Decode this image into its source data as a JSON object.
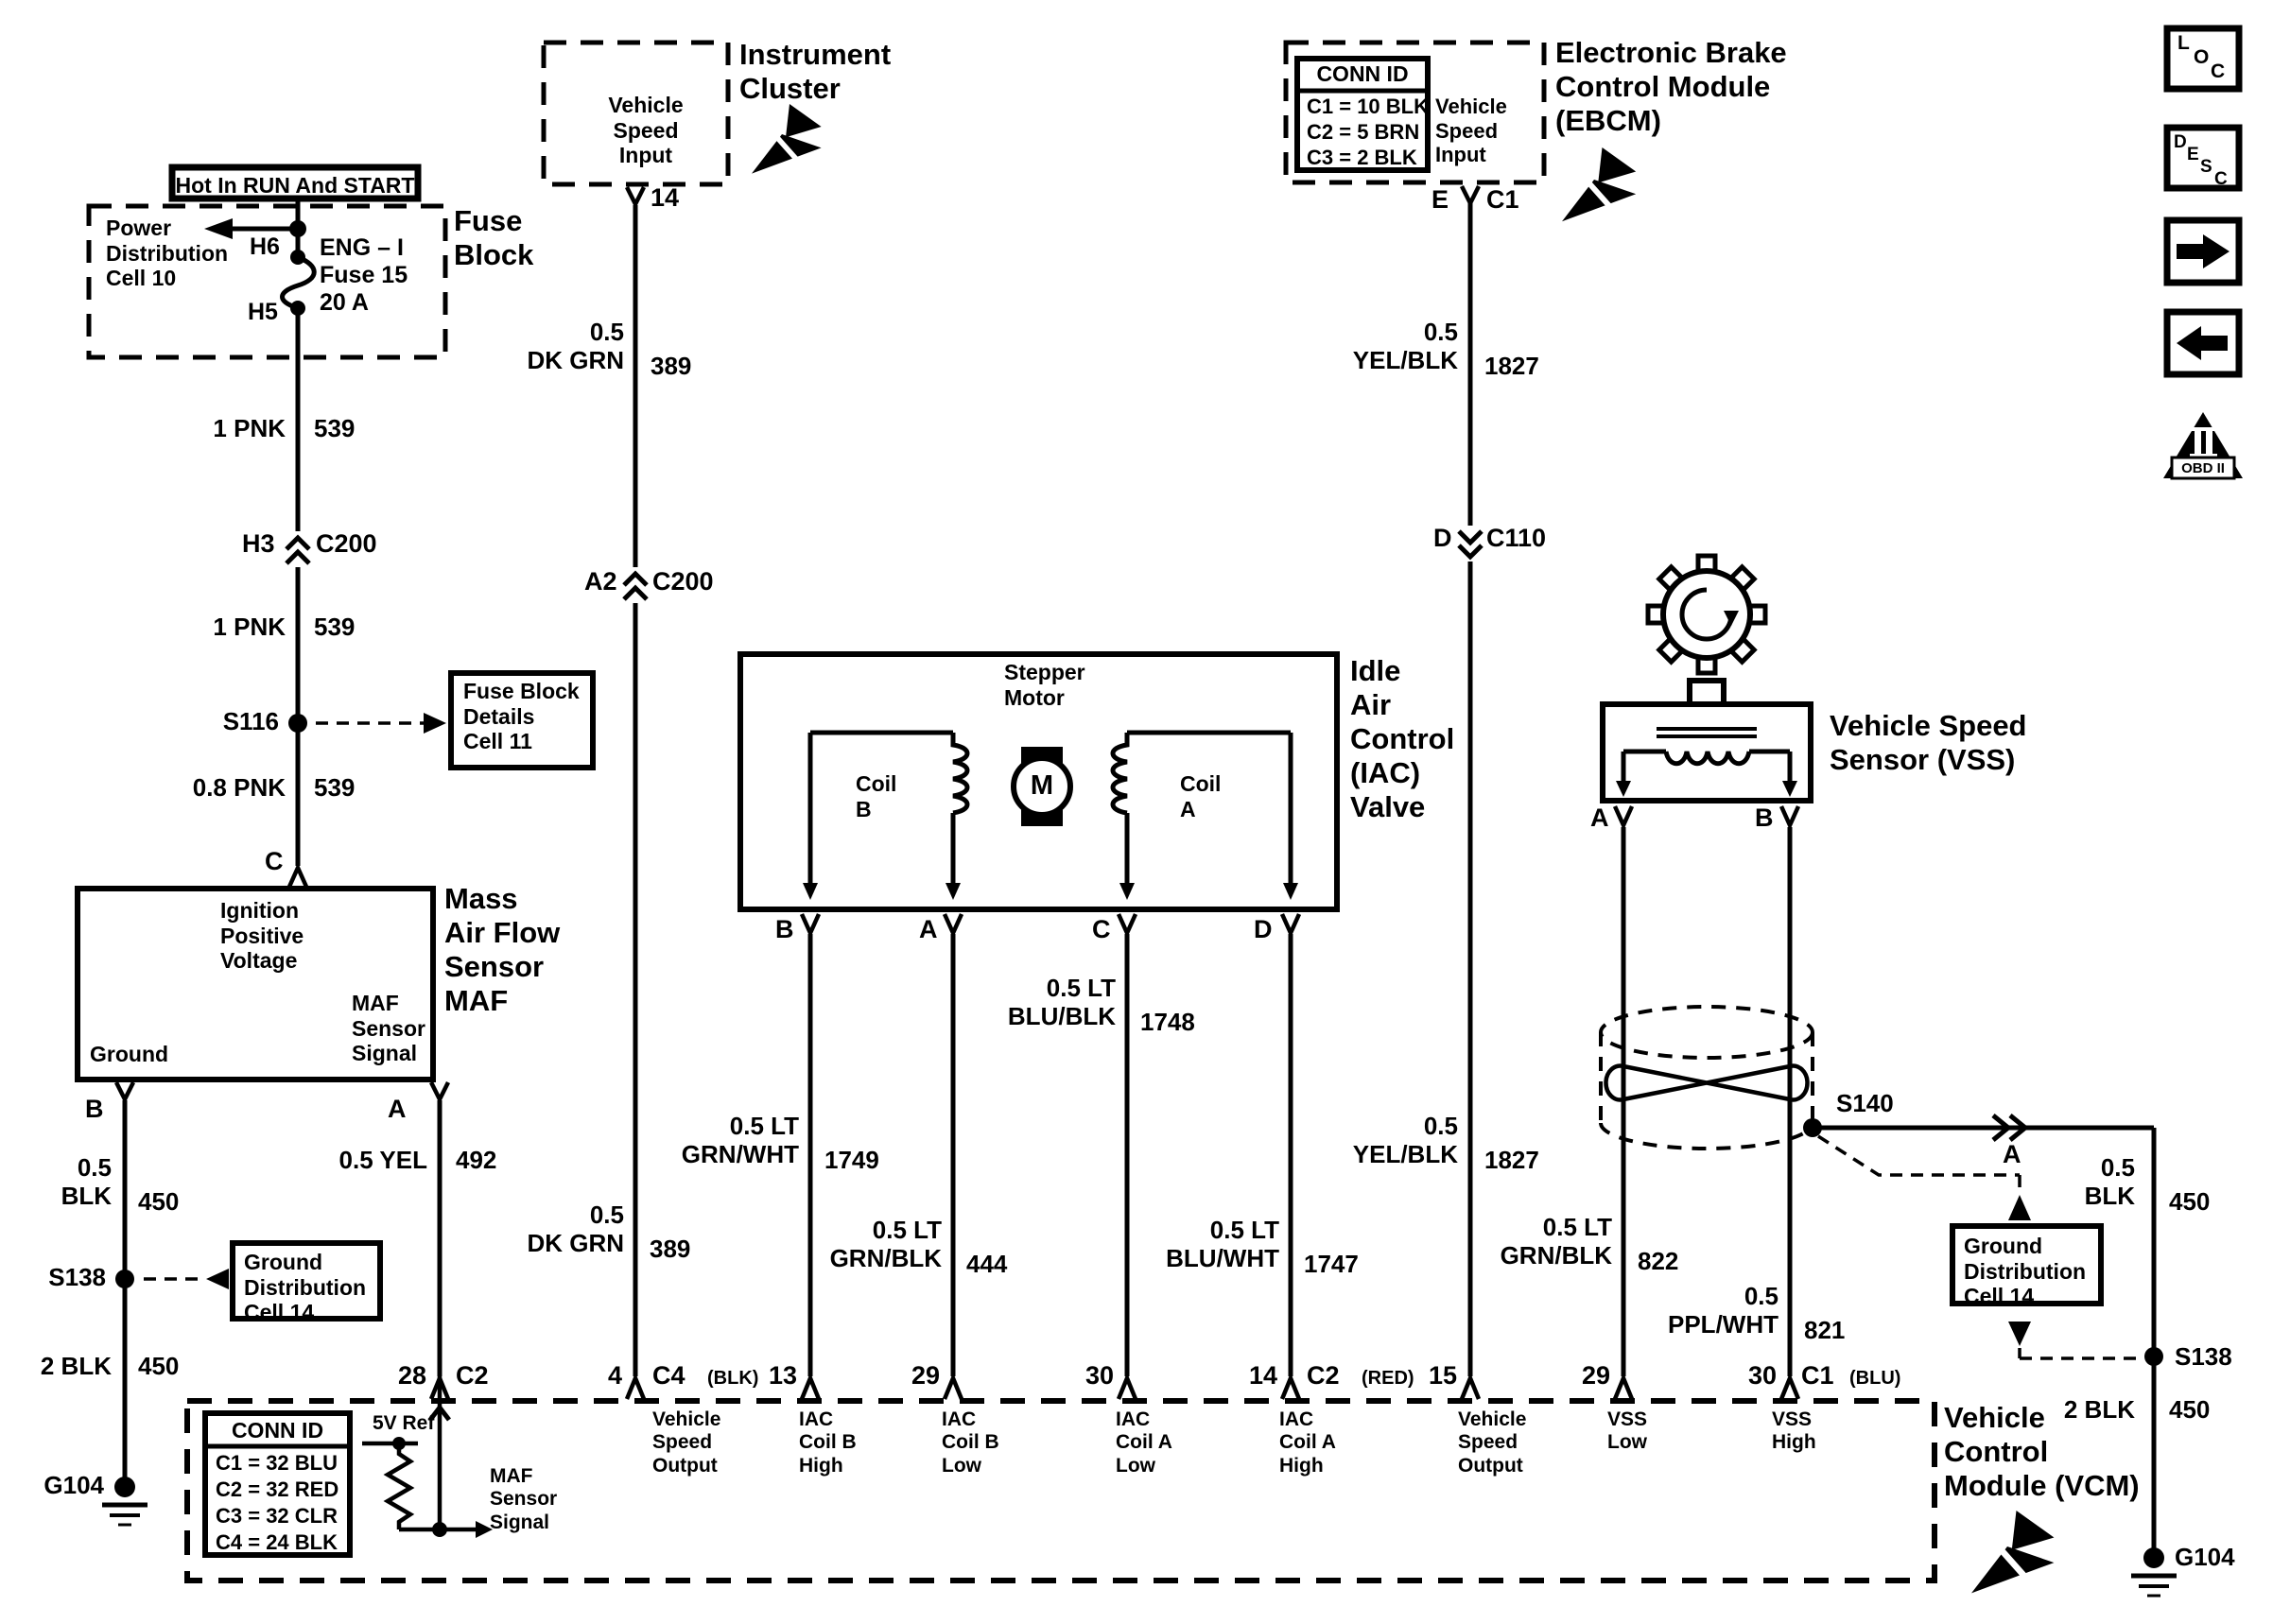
{
  "nav": {
    "loc": [
      "L",
      "O",
      "C"
    ],
    "desc": [
      "D",
      "E",
      "S",
      "C"
    ],
    "obd_pillar": "II",
    "obd_label": "OBD II"
  },
  "fuse_block": {
    "banner": "Hot In RUN And START",
    "power_distribution": "Power\nDistribution\nCell 10",
    "h6": "H6",
    "h5": "H5",
    "fuse": "ENG – I\nFuse 15\n20 A",
    "name": "Fuse\nBlock"
  },
  "instrument_cluster": {
    "input": "Vehicle\nSpeed\nInput",
    "name": "Instrument\nCluster",
    "pin": "14"
  },
  "ebcm": {
    "conn_title": "CONN ID",
    "conn_rows": [
      "C1 = 10 BLK",
      "C2 = 5 BRN",
      "C3 = 2 BLK"
    ],
    "input": "Vehicle\nSpeed\nInput",
    "name": "Electronic Brake\nControl Module\n(EBCM)",
    "pin": "E",
    "conn": "C1"
  },
  "maf": {
    "ignition": "Ignition\nPositive\nVoltage",
    "ground": "Ground",
    "signal": "MAF\nSensor\nSignal",
    "name": "Mass\nAir Flow\nSensor\nMAF",
    "pin_top": "C",
    "pin_b": "B",
    "pin_a": "A"
  },
  "iac": {
    "stepper": "Stepper\nMotor",
    "motor": "M",
    "coil_b": "Coil\nB",
    "coil_a": "Coil\nA",
    "name": "Idle\nAir\nControl\n(IAC)\nValve",
    "pins": [
      "B",
      "A",
      "C",
      "D"
    ]
  },
  "vss": {
    "name": "Vehicle Speed\nSensor (VSS)",
    "pin_a": "A",
    "pin_b": "B"
  },
  "vcm": {
    "conn_title": "CONN ID",
    "conn_rows": [
      "C1 = 32 BLU",
      "C2 = 32 RED",
      "C3 = 32 CLR",
      "C4 = 24 BLK"
    ],
    "five_v_ref": "5V Ref",
    "maf_signal": "MAF\nSensor\nSignal",
    "name": "Vehicle\nControl\nModule (VCM)",
    "pins": {
      "p28": {
        "num": "28",
        "conn": "C2"
      },
      "p4": {
        "num": "4",
        "conn": "C4",
        "note": "(BLK)",
        "label": "Vehicle\nSpeed\nOutput"
      },
      "p13": {
        "num": "13",
        "label": "IAC\nCoil B\nHigh"
      },
      "p29a": {
        "num": "29",
        "label": "IAC\nCoil B\nLow"
      },
      "p30a": {
        "num": "30",
        "label": "IAC\nCoil A\nLow"
      },
      "p14": {
        "num": "14",
        "conn": "C2",
        "note": "(RED)",
        "label": "IAC\nCoil A\nHigh"
      },
      "p15": {
        "num": "15",
        "label": "Vehicle\nSpeed\nOutput"
      },
      "p29b": {
        "num": "29",
        "label": "VSS\nLow"
      },
      "p30b": {
        "num": "30",
        "conn": "C1",
        "note": "(BLU)",
        "label": "VSS\nHigh"
      }
    }
  },
  "wires": {
    "pnk_1": {
      "spec": "1 PNK",
      "circuit": "539"
    },
    "pnk_2": {
      "spec": "1 PNK",
      "circuit": "539"
    },
    "pnk_3": {
      "spec": "0.8 PNK",
      "circuit": "539"
    },
    "dkgrn_top": {
      "spec": "0.5\nDK GRN",
      "circuit": "389"
    },
    "dkgrn_bot": {
      "spec": "0.5\nDK GRN",
      "circuit": "389"
    },
    "yel": {
      "spec": "0.5 YEL",
      "circuit": "492"
    },
    "blk_left": {
      "spec": "0.5\nBLK",
      "circuit": "450"
    },
    "blk2_left": {
      "spec": "2 BLK",
      "circuit": "450"
    },
    "grnwht": {
      "spec": "0.5 LT\nGRN/WHT",
      "circuit": "1749"
    },
    "grnblk": {
      "spec": "0.5 LT\nGRN/BLK",
      "circuit": "444"
    },
    "blublk": {
      "spec": "0.5 LT\nBLU/BLK",
      "circuit": "1748"
    },
    "bluwht": {
      "spec": "0.5 LT\nBLU/WHT",
      "circuit": "1747"
    },
    "yelblk_top": {
      "spec": "0.5\nYEL/BLK",
      "circuit": "1827"
    },
    "yelblk_bot": {
      "spec": "0.5\nYEL/BLK",
      "circuit": "1827"
    },
    "grnblk_822": {
      "spec": "0.5 LT\nGRN/BLK",
      "circuit": "822"
    },
    "pplwht": {
      "spec": "0.5\nPPL/WHT",
      "circuit": "821"
    },
    "blk_right": {
      "spec": "0.5\nBLK",
      "circuit": "450"
    },
    "blk2_right": {
      "spec": "2 BLK",
      "circuit": "450"
    }
  },
  "connectors": {
    "h3": "H3",
    "c200_h": "C200",
    "a2": "A2",
    "c200_a": "C200",
    "d": "D",
    "c110": "C110",
    "a_right": "A"
  },
  "splices": {
    "s116": "S116",
    "s138_left": "S138",
    "s138_right": "S138",
    "s140": "S140"
  },
  "grounds": {
    "left": "G104",
    "right": "G104"
  },
  "refs": {
    "fuse_details": "Fuse Block\nDetails\nCell 11",
    "gnd_left": "Ground\nDistribution\nCell 14",
    "gnd_right": "Ground\nDistribution\nCell 14"
  }
}
